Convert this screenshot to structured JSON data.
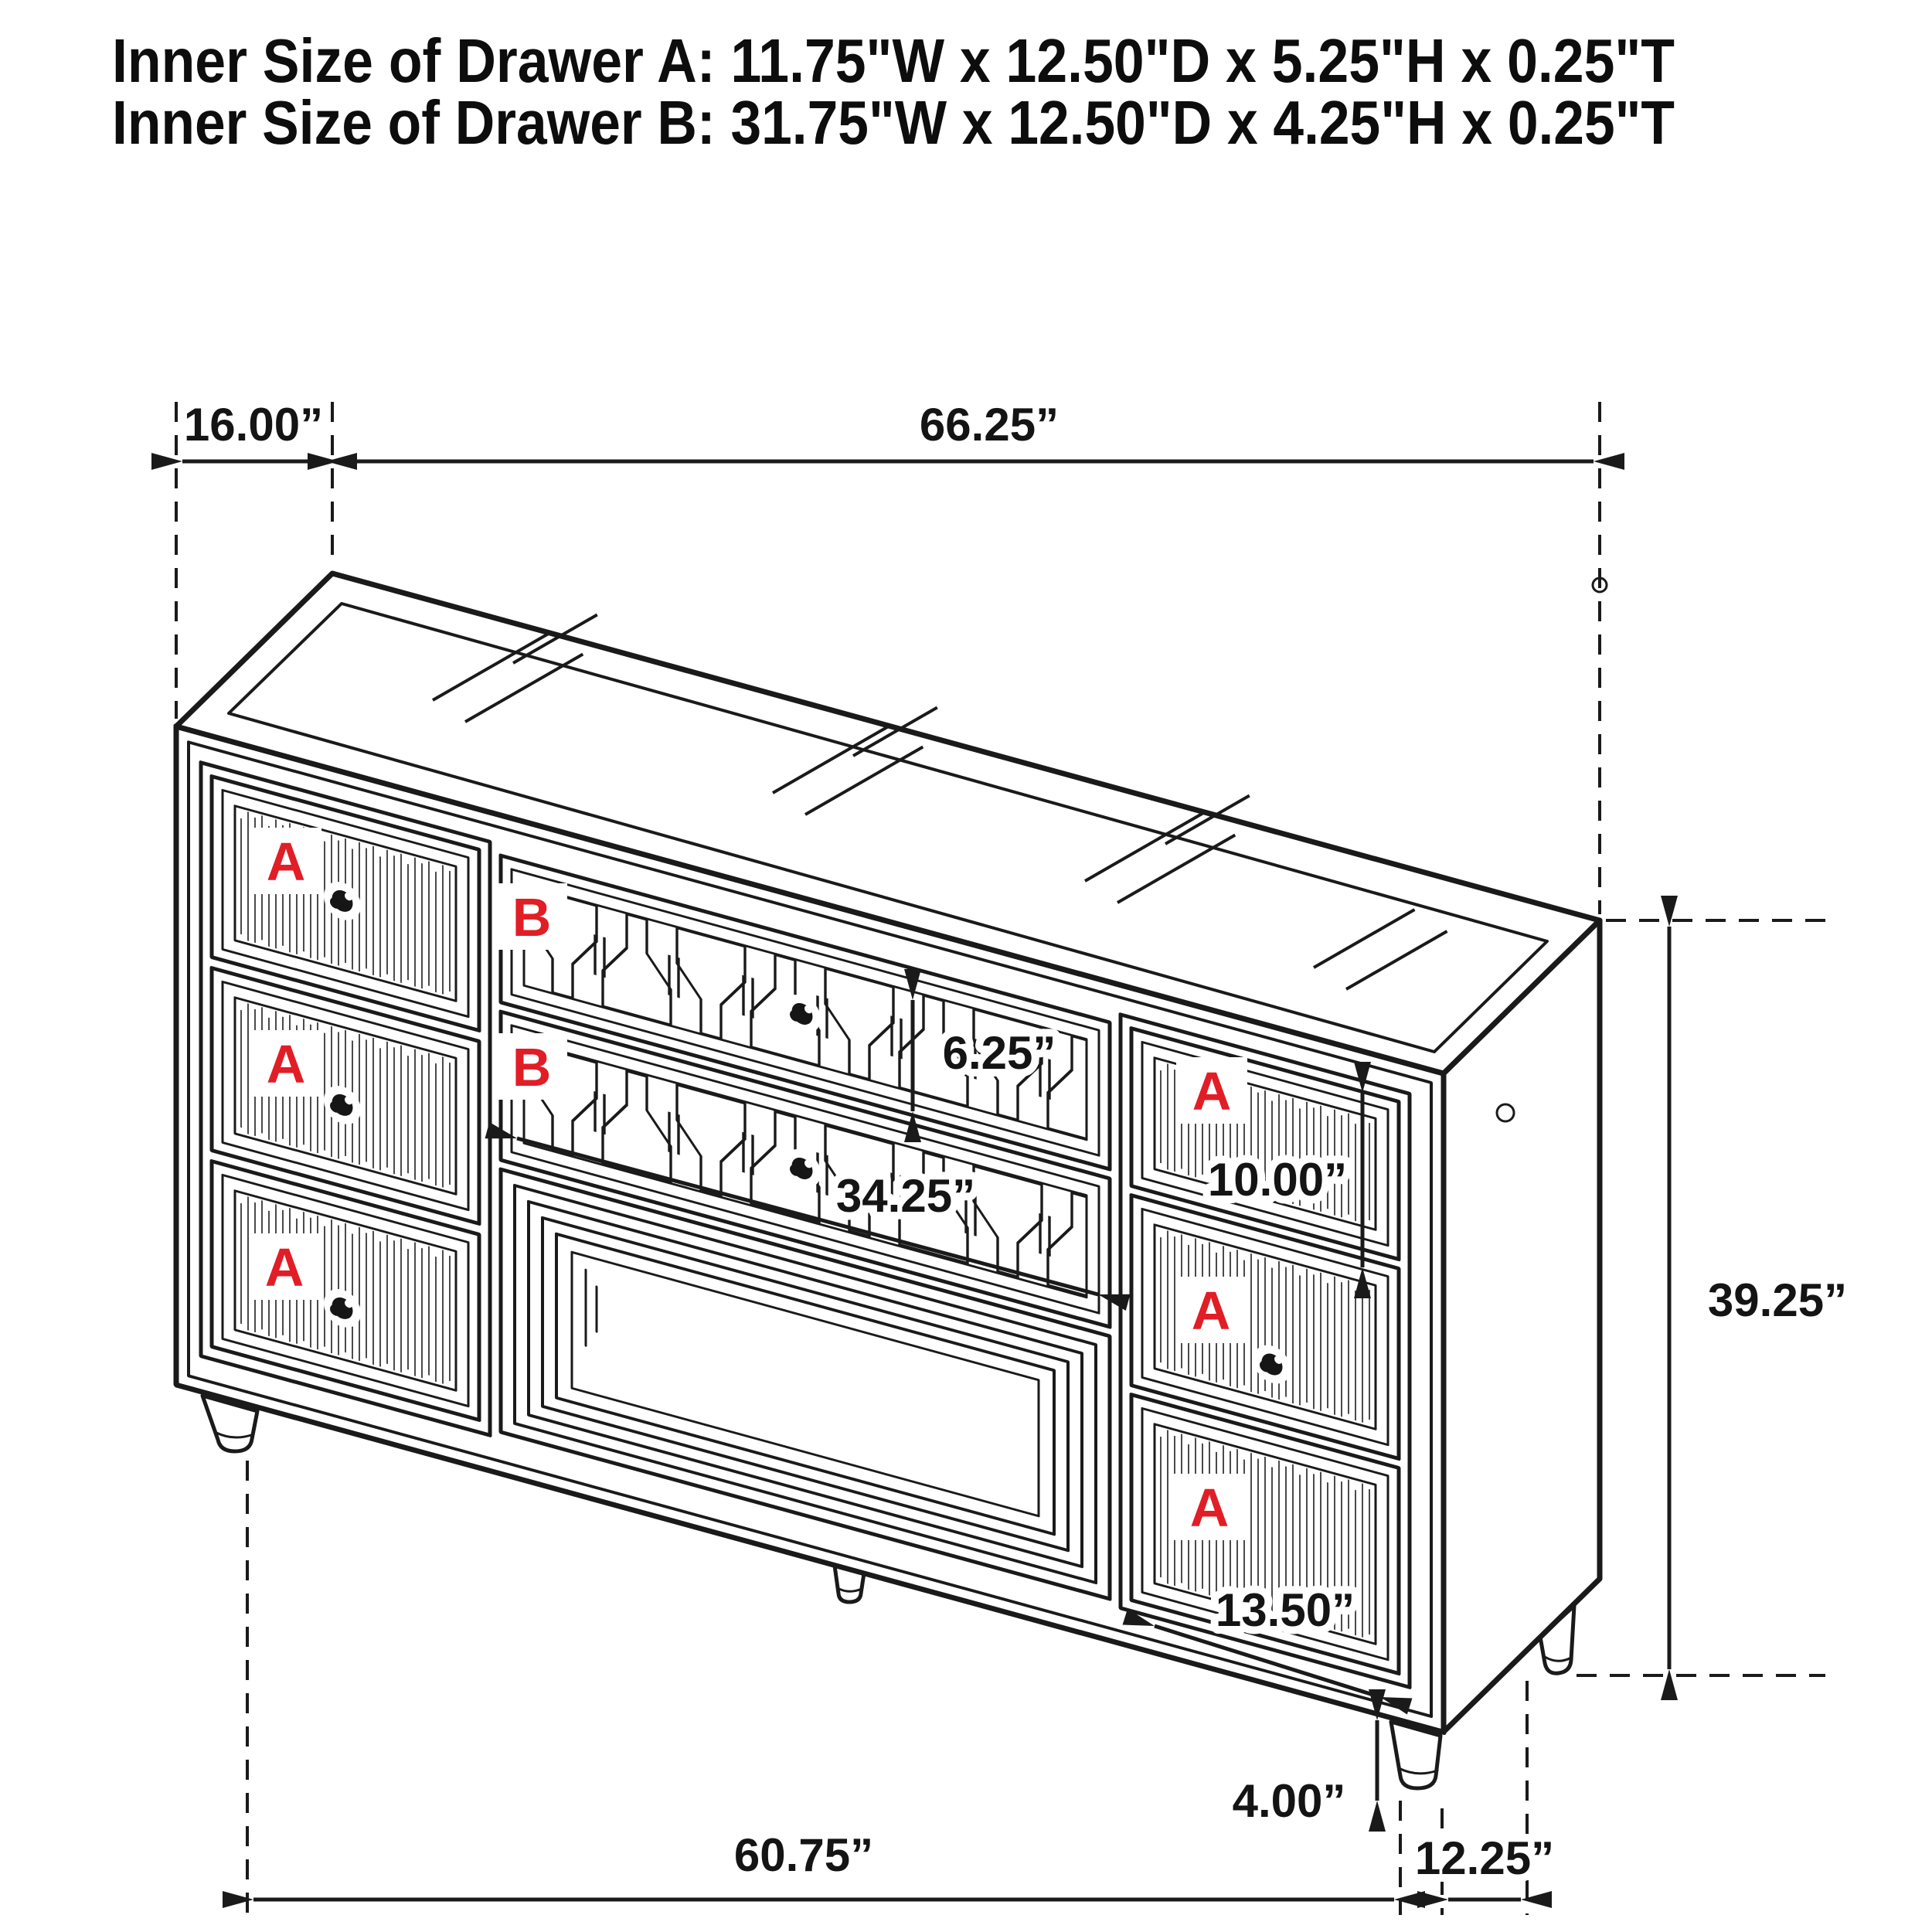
{
  "title": {
    "line1": "Inner Size of Drawer A: 11.75\"W x 12.50\"D x 5.25\"H x 0.25\"T",
    "line2": "Inner Size of Drawer B: 31.75\"W x 12.50\"D x 4.25\"H x 0.25\"T"
  },
  "drawer_labels": {
    "a": "A",
    "b": "B"
  },
  "dimensions": {
    "top_depth": "16.00”",
    "top_width": "66.25”",
    "b_drawer_height": "6.25”",
    "b_drawer_width": "34.25”",
    "a_drawer_height": "10.00”",
    "overall_height": "39.25”",
    "a_drawer_width": "13.50”",
    "leg_height": "4.00”",
    "feet_span_width": "60.75”",
    "feet_span_depth": "12.25”"
  },
  "colors": {
    "ink": "#1a1a1a",
    "accent_red": "#e11d26",
    "background": "#ffffff"
  }
}
